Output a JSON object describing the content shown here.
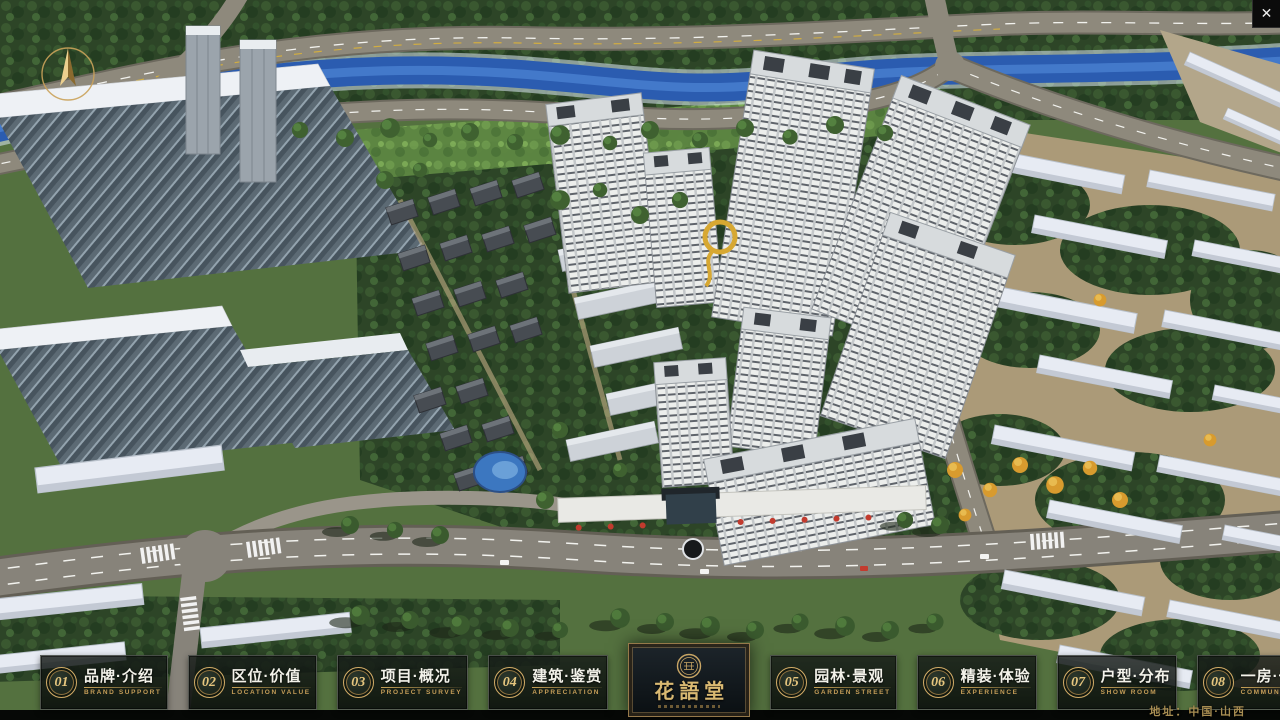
{
  "window": {
    "close_label": "✕"
  },
  "brand": {
    "logo_title": "花語堂"
  },
  "nav": {
    "items": [
      {
        "num": "01",
        "title": "品牌·介绍",
        "subtitle": "BRAND SUPPORT"
      },
      {
        "num": "02",
        "title": "区位·价值",
        "subtitle": "LOCATION VALUE"
      },
      {
        "num": "03",
        "title": "项目·概况",
        "subtitle": "PROJECT SURVEY"
      },
      {
        "num": "04",
        "title": "建筑·鉴赏",
        "subtitle": "APPRECIATION"
      },
      {
        "num": "05",
        "title": "园林·景观",
        "subtitle": "GARDEN STREET"
      },
      {
        "num": "06",
        "title": "精装·体验",
        "subtitle": "EXPERIENCE"
      },
      {
        "num": "07",
        "title": "户型·分布",
        "subtitle": "SHOW ROOM"
      },
      {
        "num": "08",
        "title": "一房·一景",
        "subtitle": "COMMUNITY"
      }
    ]
  },
  "footer": {
    "address": "地址：中国·山西"
  },
  "colors": {
    "accent_gold": "#c9a257",
    "water_blue": "#2b5cb0",
    "panel_dark": "#0c110e"
  }
}
